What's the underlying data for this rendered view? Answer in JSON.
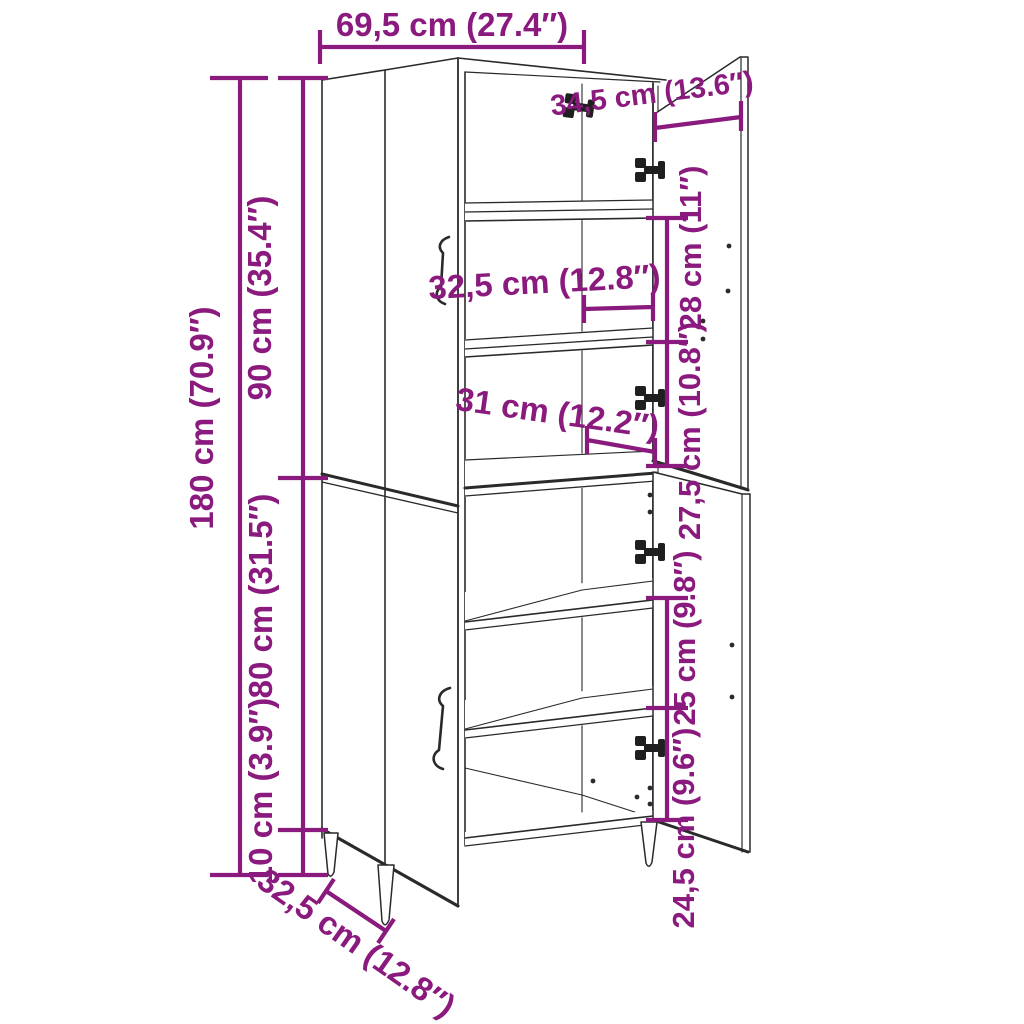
{
  "diagram": {
    "kind": "furniture-dimension-diagram",
    "subject": "tall two-section highboard cabinet with open right doors, interior shelves and tapered legs"
  },
  "colors": {
    "dimension_annotation": "#8a1a7e",
    "line_art": "#2a2a2a",
    "hardware": "#1f1f1f",
    "background": "#ffffff"
  },
  "labels": {
    "width_top": "69,5 cm (27.4″)",
    "depth_top": "34,5 cm (13.6″)",
    "height_total": "180 cm (70.9″)",
    "height_upper_section": "90 cm (35.4″)",
    "height_lower_section": "80 cm (31.5″)",
    "leg_height": "10 cm (3.9″)",
    "upper_shelf_spacing": "32,5 cm (12.8″)",
    "middle_shelf_spacing": "31 cm (12.2″)",
    "right_upper_gap": "28 cm (11″)",
    "right_middle_gap": "27,5 cm (10.8″)",
    "right_lower_gap": "25 cm (9.8″)",
    "right_bottom_gap": "24,5 cm (9.6″)",
    "base_depth": "32,5 cm (12.8″)"
  }
}
